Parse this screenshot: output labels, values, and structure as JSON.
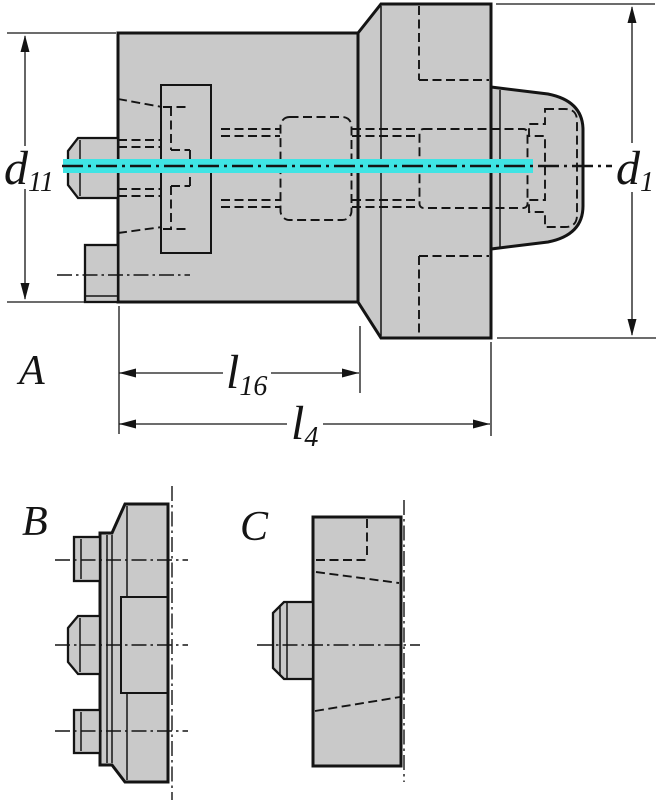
{
  "drawing": {
    "view_labels": {
      "a": "A",
      "b": "B",
      "c": "C"
    },
    "dimension_labels": {
      "d11": {
        "base": "d",
        "sub": "11"
      },
      "d1": {
        "base": "d",
        "sub": "1"
      },
      "l16": {
        "base": "l",
        "sub": "16"
      },
      "l4": {
        "base": "l",
        "sub": "4"
      }
    },
    "colors": {
      "part_fill": "#C9C9C9",
      "line": "#141414",
      "highlight_centerline": "#3FE4E4",
      "background": "#FFFFFF"
    }
  }
}
